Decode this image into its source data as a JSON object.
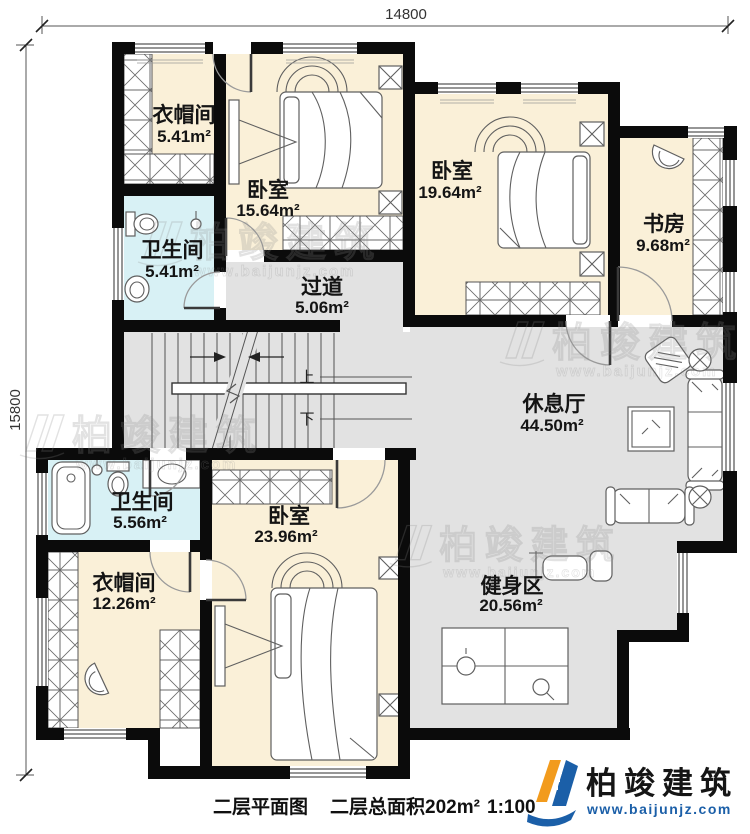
{
  "dimensions": {
    "top": "14800",
    "left": "15800"
  },
  "rooms": {
    "cloakroom1": {
      "name": "衣帽间",
      "area": "5.41m²"
    },
    "bedroom1": {
      "name": "卧室",
      "area": "15.64m²"
    },
    "bedroom2": {
      "name": "卧室",
      "area": "19.64m²"
    },
    "study": {
      "name": "书房",
      "area": "9.68m²"
    },
    "bathroom1": {
      "name": "卫生间",
      "area": "5.41m²"
    },
    "corridor": {
      "name": "过道",
      "area": "5.06m²"
    },
    "lounge": {
      "name": "休息厅",
      "area": "44.50m²"
    },
    "bathroom2": {
      "name": "卫生间",
      "area": "5.56m²"
    },
    "cloakroom2": {
      "name": "衣帽间",
      "area": "12.26m²"
    },
    "bedroom3": {
      "name": "卧室",
      "area": "23.96m²"
    },
    "gym": {
      "name": "健身区",
      "area": "20.56m²"
    }
  },
  "stairs": {
    "up_label": "上",
    "down_label": "下"
  },
  "caption": {
    "plan_title": "二层平面图",
    "total_area": "二层总面积202m²",
    "scale": "1:100"
  },
  "watermark": {
    "brand": "柏竣建筑",
    "website": "www.baijunjz.com"
  },
  "logo": {
    "brand": "柏竣建筑",
    "website": "www.baijunjz.com"
  },
  "colors": {
    "wall": "#0b0b0b",
    "room_warm": "#faf0d8",
    "room_wet": "#d8f1f5",
    "room_circulation": "#e2e2e2",
    "logo_blue": "#1b5fa8",
    "logo_orange": "#f29b1d"
  }
}
